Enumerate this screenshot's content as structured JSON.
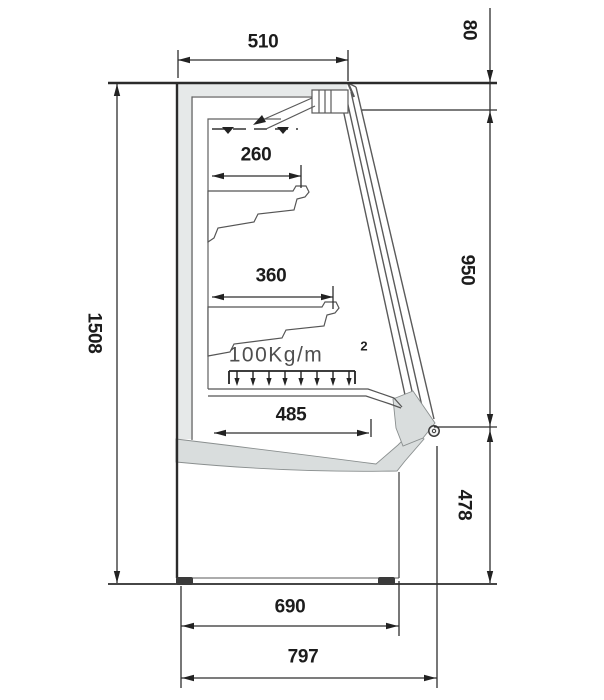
{
  "drawing": {
    "dimensions": {
      "top_width": "510",
      "canopy_front_height": "80",
      "overall_height": "1508",
      "glass_opening_height": "950",
      "base_height": "478",
      "top_shelf_depth": "260",
      "middle_shelf_depth": "360",
      "bottom_deck_depth": "485",
      "base_depth": "690",
      "overall_depth": "797"
    },
    "shelf_load_rating": {
      "value": "100Kg/m",
      "superscript": "2"
    }
  }
}
